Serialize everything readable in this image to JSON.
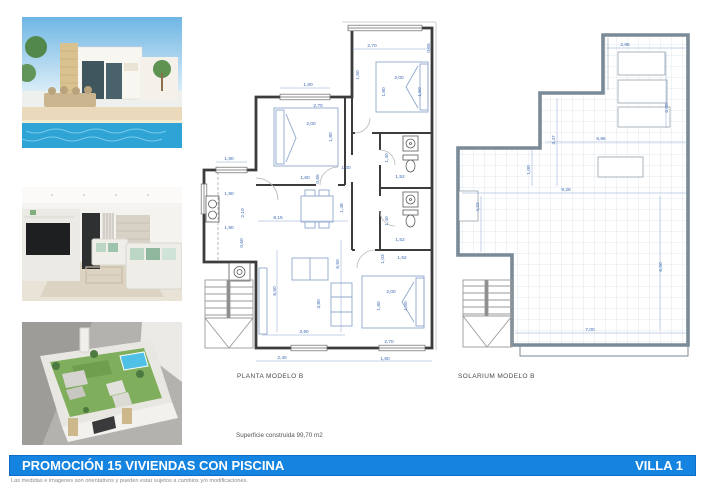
{
  "page": {
    "footer_bar": {
      "title": "PROMOCIÓN 15 VIVIENDAS CON PISCINA",
      "villa": "VILLA 1",
      "color": "#1583e0"
    },
    "surface_note": "Superficie construida 99,70 m2",
    "disclaimer": "Las medidas e imagenes son orientativos y pueden estar sujetos a cambios y/o modificaciones."
  },
  "photos": [
    {
      "name": "villa-exterior-pool",
      "alt": "Exterior of white villa with stone pillar, palms and swimming pool"
    },
    {
      "name": "living-room-interior",
      "alt": "Living room with TV wall unit and white sofas"
    },
    {
      "name": "rooftop-solarium-aerial",
      "alt": "Aerial 3D view of rooftop solarium with lawn and jacuzzi"
    }
  ],
  "planta": {
    "label": "PLANTA MODELO B",
    "dims": [
      {
        "x": 372,
        "y": 47,
        "t": "2,70"
      },
      {
        "x": 430,
        "y": 48,
        "t": "0,65",
        "r": 1
      },
      {
        "x": 359,
        "y": 75,
        "t": "1,50",
        "r": 1
      },
      {
        "x": 399,
        "y": 79,
        "t": "2,00"
      },
      {
        "x": 385,
        "y": 92,
        "t": "1,80",
        "r": 1
      },
      {
        "x": 421,
        "y": 92,
        "t": "1,50",
        "r": 1
      },
      {
        "x": 308,
        "y": 86,
        "t": "1,80"
      },
      {
        "x": 318,
        "y": 107,
        "t": "2,70"
      },
      {
        "x": 311,
        "y": 125,
        "t": "2,00"
      },
      {
        "x": 332,
        "y": 137,
        "t": "1,80",
        "r": 1
      },
      {
        "x": 346,
        "y": 169,
        "t": "1,00"
      },
      {
        "x": 305,
        "y": 179,
        "t": "1,60"
      },
      {
        "x": 319,
        "y": 179,
        "t": "0,65",
        "r": 1
      },
      {
        "x": 229,
        "y": 160,
        "t": "1,80"
      },
      {
        "x": 229,
        "y": 195,
        "t": "1,90"
      },
      {
        "x": 244,
        "y": 213,
        "t": "2,10",
        "r": 1
      },
      {
        "x": 229,
        "y": 229,
        "t": "1,90"
      },
      {
        "x": 243,
        "y": 243,
        "t": "0,60",
        "r": 1
      },
      {
        "x": 278,
        "y": 219,
        "t": "8,15"
      },
      {
        "x": 343,
        "y": 208,
        "t": "1,48",
        "r": 1
      },
      {
        "x": 388,
        "y": 158,
        "t": "1,40",
        "r": 1
      },
      {
        "x": 400,
        "y": 178,
        "t": "1,52"
      },
      {
        "x": 388,
        "y": 221,
        "t": "1,40",
        "r": 1
      },
      {
        "x": 400,
        "y": 241,
        "t": "1,52"
      },
      {
        "x": 384,
        "y": 259,
        "t": "1,03",
        "r": 1
      },
      {
        "x": 402,
        "y": 259,
        "t": "1,52"
      },
      {
        "x": 339,
        "y": 264,
        "t": "6,50",
        "r": 1
      },
      {
        "x": 320,
        "y": 304,
        "t": "3,80",
        "r": 1
      },
      {
        "x": 391,
        "y": 293,
        "t": "2,00"
      },
      {
        "x": 380,
        "y": 306,
        "t": "1,80",
        "r": 1
      },
      {
        "x": 407,
        "y": 306,
        "t": "1,50",
        "r": 1
      },
      {
        "x": 304,
        "y": 333,
        "t": "3,90"
      },
      {
        "x": 282,
        "y": 359,
        "t": "2,40"
      },
      {
        "x": 385,
        "y": 360,
        "t": "1,60"
      },
      {
        "x": 389,
        "y": 343,
        "t": "2,70"
      },
      {
        "x": 276,
        "y": 291,
        "t": "6,50",
        "r": 1
      }
    ]
  },
  "solarium": {
    "label": "SOLARIUM MODELO B",
    "dims": [
      {
        "x": 625,
        "y": 46,
        "t": "2,85"
      },
      {
        "x": 668,
        "y": 108,
        "t": "6,08",
        "r": 1
      },
      {
        "x": 555,
        "y": 140,
        "t": "3,47",
        "r": 1
      },
      {
        "x": 530,
        "y": 170,
        "t": "1,00",
        "r": 1
      },
      {
        "x": 601,
        "y": 140,
        "t": "6,86"
      },
      {
        "x": 566,
        "y": 191,
        "t": "9,26"
      },
      {
        "x": 479,
        "y": 207,
        "t": "4,22",
        "r": 1
      },
      {
        "x": 662,
        "y": 267,
        "t": "6,50",
        "r": 1
      },
      {
        "x": 590,
        "y": 331,
        "t": "7,00"
      }
    ]
  },
  "colors": {
    "dim_text": "#3f6bb5",
    "wall": "#3c3c3c",
    "tile_grid": "#ccd8e2",
    "bar_blue": "#1583e0"
  }
}
